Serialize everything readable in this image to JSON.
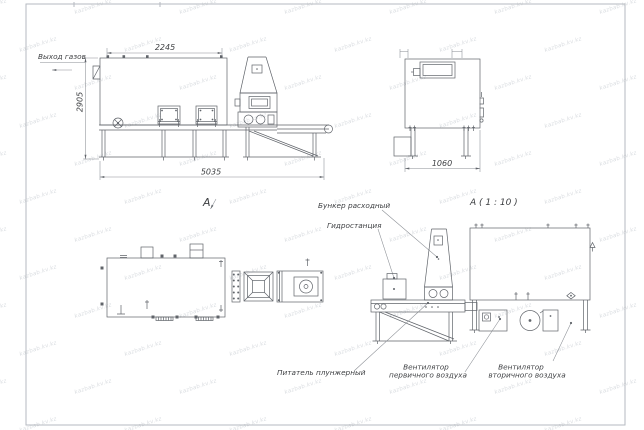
{
  "sheet": {
    "watermark_text": "kazbab.kv.kz",
    "line_color": "#60646a",
    "frame_color": "#b6bac0",
    "text_color": "#3d3f42",
    "background": "#ffffff"
  },
  "front_view": {
    "gas_outlet_label": "Выход газов",
    "dim_top_width": "2245",
    "dim_height": "2905",
    "dim_total_length": "5035",
    "section_arrow_label": "A"
  },
  "side_view": {
    "dim_width": "1060"
  },
  "section_view": {
    "title": "A ( 1 : 10 )",
    "feed_bunker_label": "Бункер расходный",
    "hydrostation_label": "Гидростанция",
    "plunger_feeder_label": "Питатель плунжерный",
    "primary_fan_label_line1": "Вентилятор",
    "primary_fan_label_line2": "первичного воздуха",
    "secondary_fan_label_line1": "Вентилятор",
    "secondary_fan_label_line2": "вторичного воздуха"
  }
}
